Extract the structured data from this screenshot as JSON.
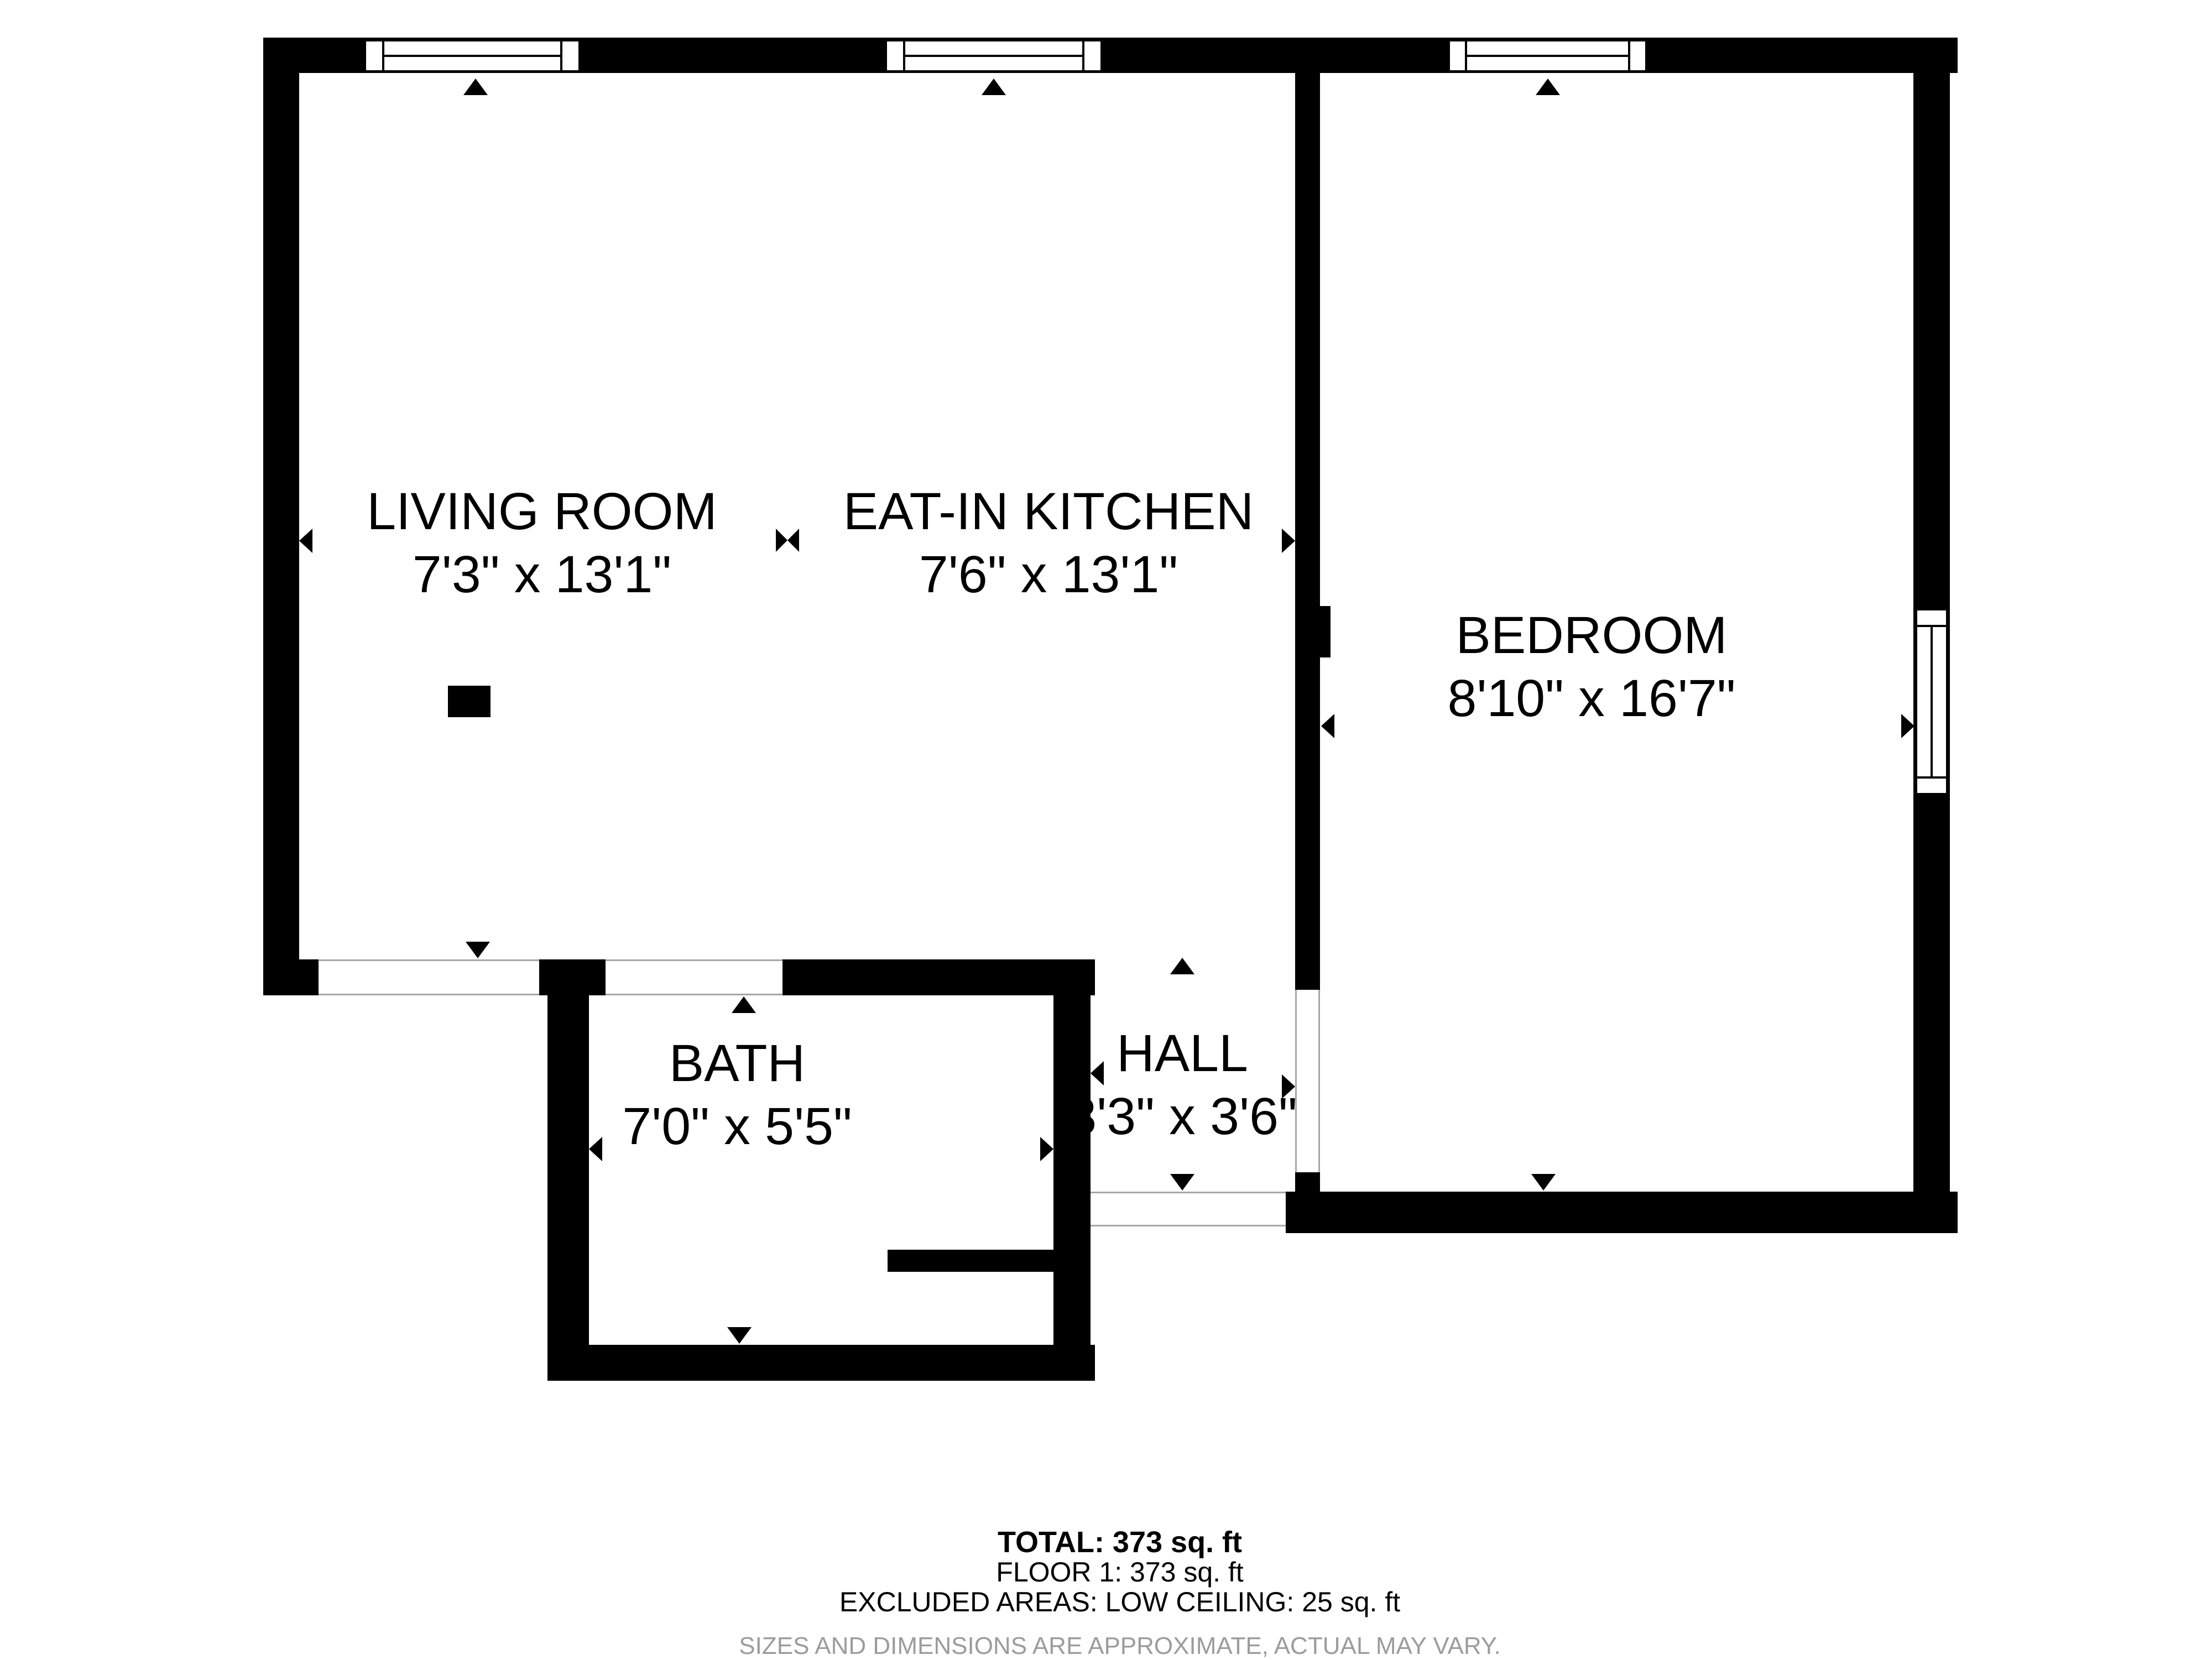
{
  "rooms": [
    {
      "name": "LIVING ROOM",
      "dims": "7'3\" x 13'1\""
    },
    {
      "name": "EAT-IN KITCHEN",
      "dims": "7'6\" x 13'1\""
    },
    {
      "name": "BEDROOM",
      "dims": "8'10\" x 16'7\""
    },
    {
      "name": "BATH",
      "dims": "7'0\" x 5'5\""
    },
    {
      "name": "HALL",
      "dims": "3'3\" x 3'6\""
    }
  ],
  "footer": {
    "total": "TOTAL: 373 sq. ft",
    "floor": "FLOOR 1: 373 sq. ft",
    "excluded": "EXCLUDED AREAS: LOW CEILING: 25 sq. ft",
    "disclaimer": "SIZES AND DIMENSIONS ARE APPROXIMATE, ACTUAL MAY VARY."
  },
  "colors": {
    "wall": "#000000",
    "background": "#ffffff",
    "disclaimer_gray": "#9c9c9c",
    "opening_line": "#a6a6a6"
  }
}
